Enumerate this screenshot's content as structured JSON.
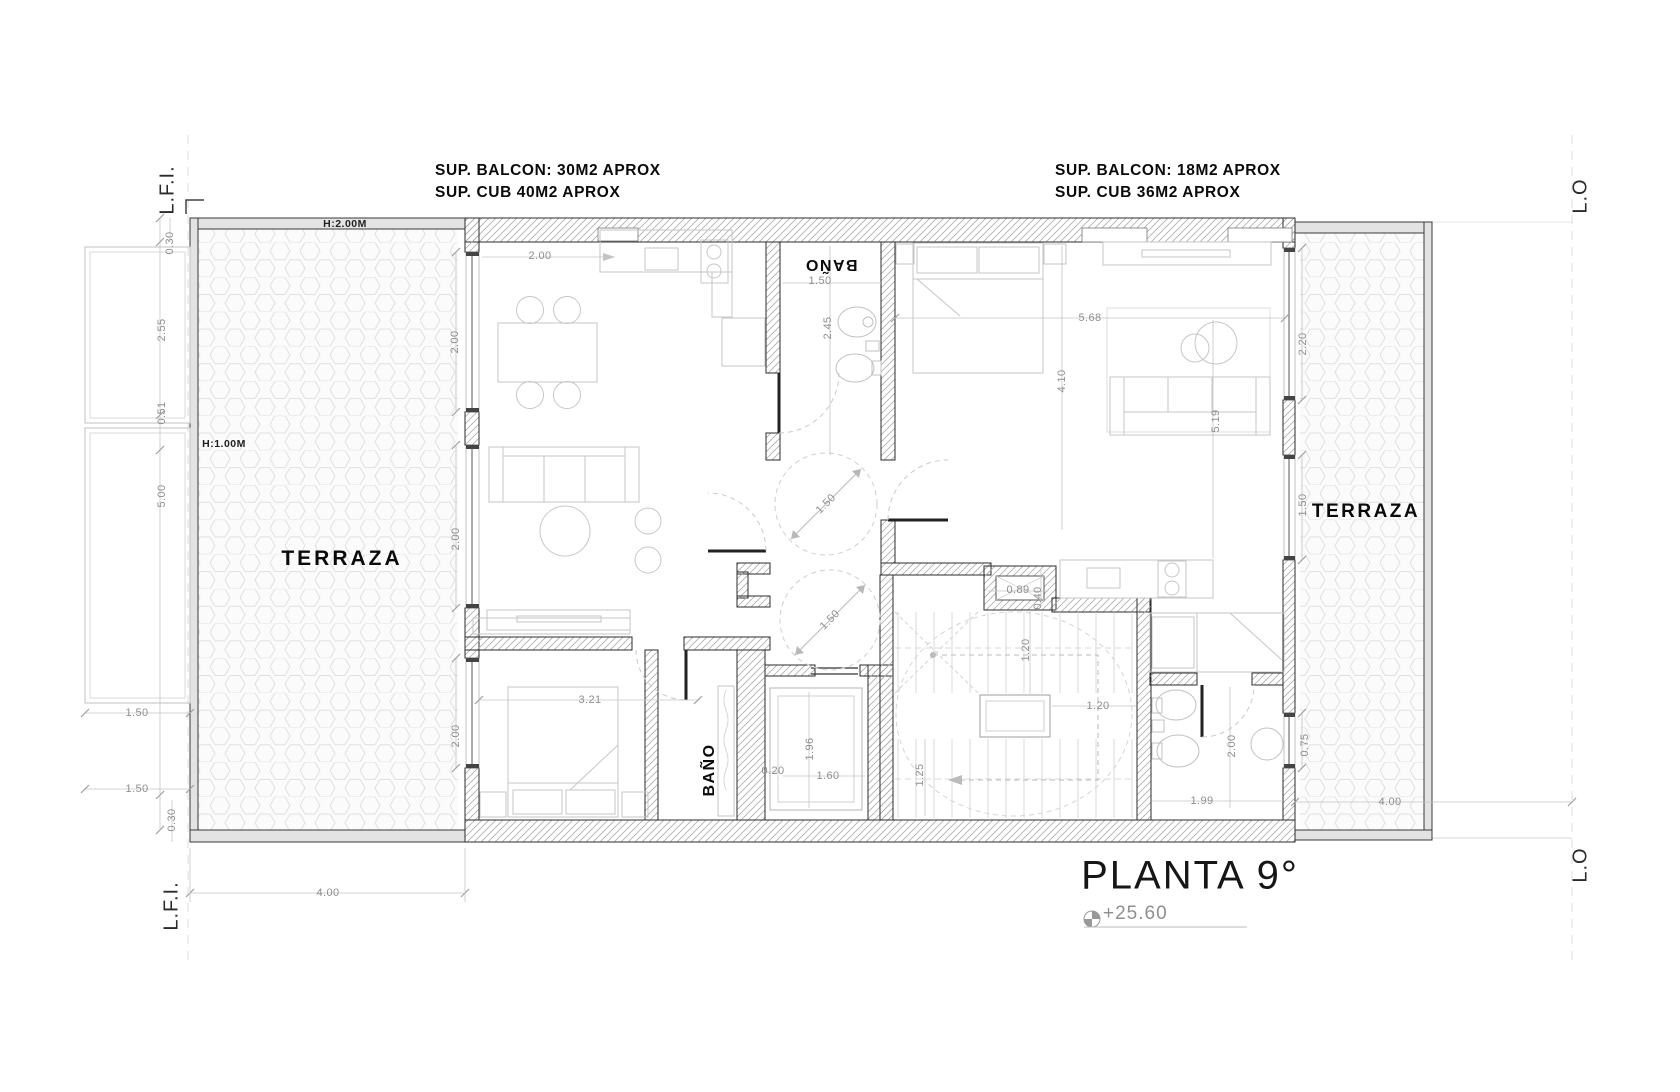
{
  "title": {
    "text": "PLANTA 9°",
    "level": "+25.60"
  },
  "boundaries": {
    "lfi_top": "L.F.I.",
    "lfi_bottom": "L.F.I.",
    "lo_top": "L.O",
    "lo_bottom": "L.O"
  },
  "area_notes": {
    "left": {
      "line1": "SUP. BALCON: 30M2 APROX",
      "line2": "SUP. CUB 40M2 APROX"
    },
    "right": {
      "line1": "SUP. BALCON: 18M2 APROX",
      "line2": "SUP. CUB 36M2 APROX"
    }
  },
  "room_labels": [
    {
      "text": "TERRAZA",
      "x": 342,
      "y": 559,
      "rot": 0,
      "cls": "room-lg"
    },
    {
      "text": "TERRAZA",
      "x": 1366,
      "y": 512,
      "rot": 0,
      "cls": "room-md"
    },
    {
      "text": "BAÑO",
      "x": 831,
      "y": 264,
      "rot": 180,
      "cls": "room-sm"
    },
    {
      "text": "BAÑO",
      "x": 710,
      "y": 770,
      "rot": -90,
      "cls": "room-sm"
    },
    {
      "text": "H:2.00M",
      "x": 345,
      "y": 224,
      "rot": 0,
      "cls": "note-sm"
    },
    {
      "text": "H:1.00M",
      "x": 224,
      "y": 444,
      "rot": 0,
      "cls": "note-sm"
    }
  ],
  "dimensions": [
    {
      "text": "0.30",
      "x": 170,
      "y": 243,
      "rot": -90
    },
    {
      "text": "2.55",
      "x": 162,
      "y": 330,
      "rot": -90
    },
    {
      "text": "0.51",
      "x": 162,
      "y": 413,
      "rot": -90
    },
    {
      "text": "5.00",
      "x": 162,
      "y": 496,
      "rot": -90
    },
    {
      "text": "1.50",
      "x": 137,
      "y": 713,
      "rot": 0
    },
    {
      "text": "1.50",
      "x": 137,
      "y": 789,
      "rot": 0
    },
    {
      "text": "0.30",
      "x": 172,
      "y": 820,
      "rot": -90
    },
    {
      "text": "4.00",
      "x": 328,
      "y": 893,
      "rot": 0
    },
    {
      "text": "2.00",
      "x": 455,
      "y": 342,
      "rot": -90
    },
    {
      "text": "2.00",
      "x": 456,
      "y": 539,
      "rot": -90
    },
    {
      "text": "2.00",
      "x": 456,
      "y": 736,
      "rot": -90
    },
    {
      "text": "2.00",
      "x": 540,
      "y": 256,
      "rot": 0
    },
    {
      "text": "1.50",
      "x": 820,
      "y": 281,
      "rot": 0
    },
    {
      "text": "2.45",
      "x": 828,
      "y": 328,
      "rot": -90
    },
    {
      "text": "5.68",
      "x": 1090,
      "y": 318,
      "rot": 0
    },
    {
      "text": "4.10",
      "x": 1062,
      "y": 381,
      "rot": -90
    },
    {
      "text": "5.19",
      "x": 1216,
      "y": 421,
      "rot": -90
    },
    {
      "text": "2.20",
      "x": 1303,
      "y": 344,
      "rot": -90
    },
    {
      "text": "1.50",
      "x": 1303,
      "y": 505,
      "rot": -90
    },
    {
      "text": "1.50",
      "x": 826,
      "y": 504,
      "rot": -45
    },
    {
      "text": "1.50",
      "x": 830,
      "y": 620,
      "rot": -45
    },
    {
      "text": "3.21",
      "x": 590,
      "y": 700,
      "rot": 0
    },
    {
      "text": "0.20",
      "x": 773,
      "y": 771,
      "rot": 0
    },
    {
      "text": "1.96",
      "x": 810,
      "y": 749,
      "rot": -90
    },
    {
      "text": "1.60",
      "x": 828,
      "y": 776,
      "rot": 0
    },
    {
      "text": "0.89",
      "x": 1018,
      "y": 590,
      "rot": 0
    },
    {
      "text": "0.40",
      "x": 1038,
      "y": 598,
      "rot": -90
    },
    {
      "text": "1.20",
      "x": 1026,
      "y": 650,
      "rot": -90
    },
    {
      "text": "1.20",
      "x": 1098,
      "y": 706,
      "rot": 0
    },
    {
      "text": "1.25",
      "x": 920,
      "y": 775,
      "rot": -90
    },
    {
      "text": "2.00",
      "x": 1232,
      "y": 746,
      "rot": -90
    },
    {
      "text": "1.99",
      "x": 1202,
      "y": 801,
      "rot": 0
    },
    {
      "text": "0.75",
      "x": 1305,
      "y": 745,
      "rot": -90
    },
    {
      "text": "4.00",
      "x": 1390,
      "y": 802,
      "rot": 0
    }
  ],
  "colors": {
    "wall_line": "#2b2b2b",
    "hatch": "#adadad",
    "dim": "#8f8f8f",
    "furniture": "#c6c6c6"
  }
}
